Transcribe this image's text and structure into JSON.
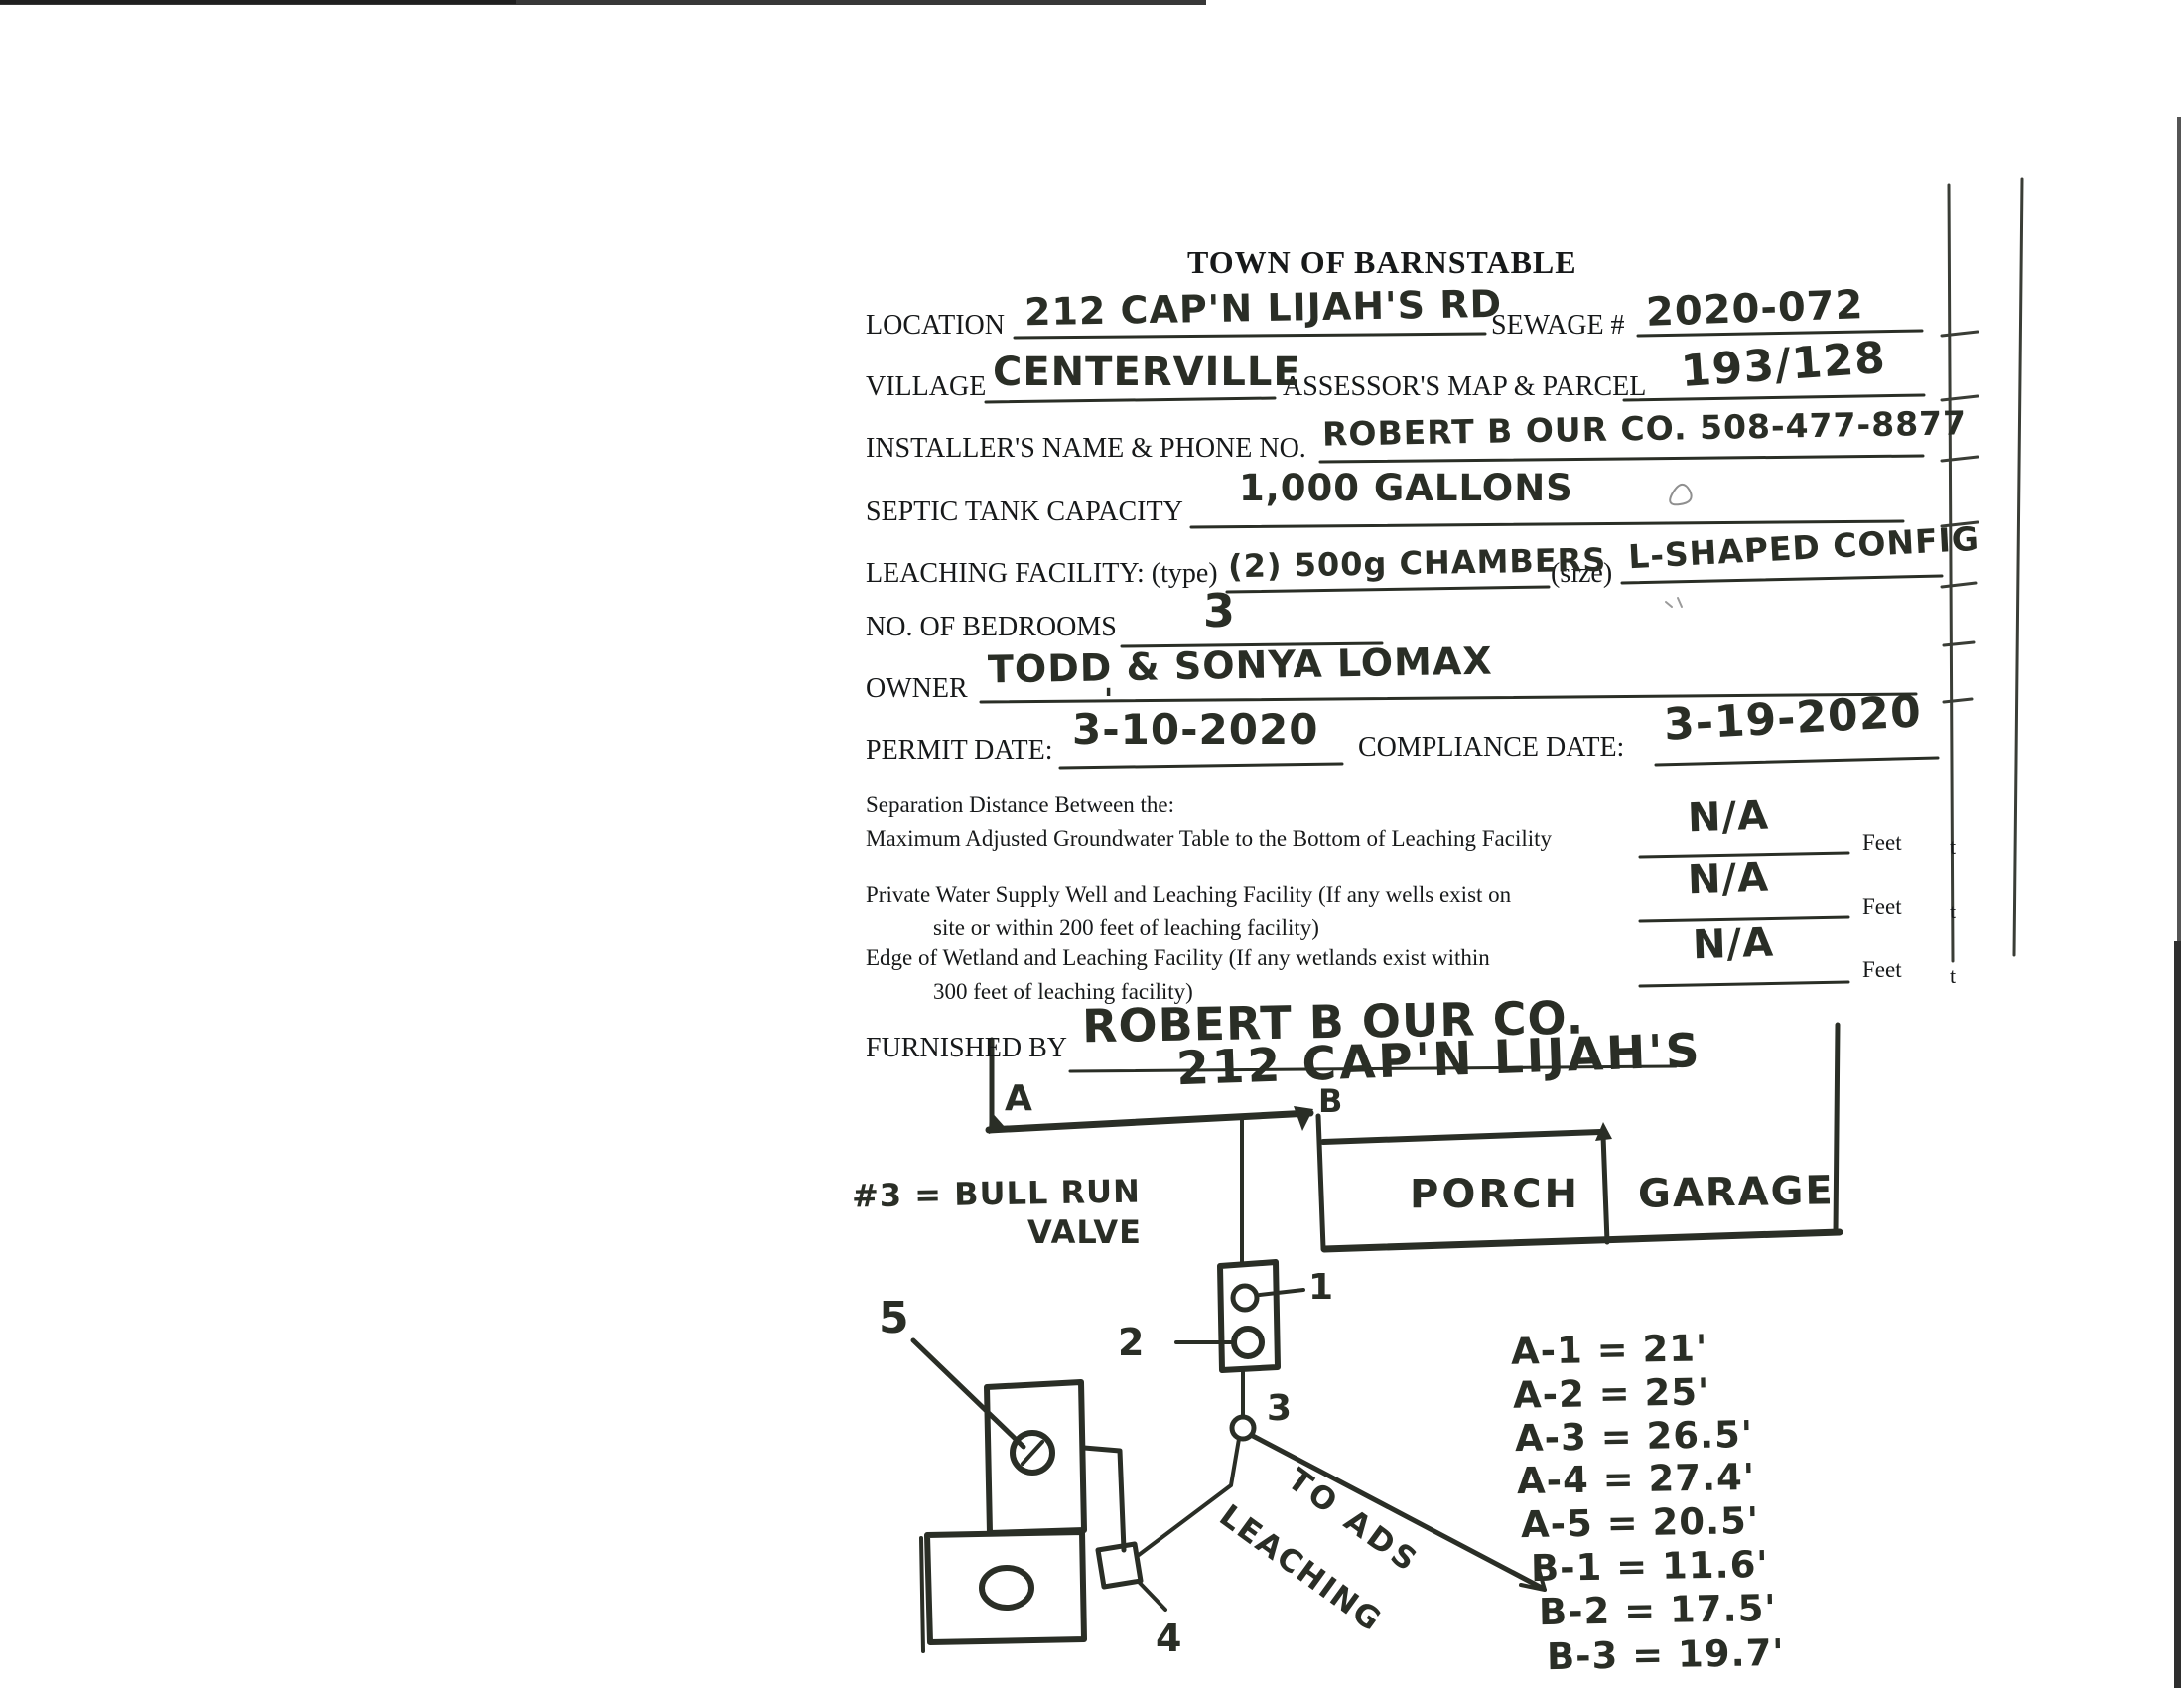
{
  "colors": {
    "ink": "#2a2e26",
    "label_ink": "#17191a",
    "paper": "#ffffff"
  },
  "form": {
    "title": "TOWN OF BARNSTABLE",
    "location_label": "LOCATION",
    "location_value": "212 CAP'N LIJAH'S RD",
    "sewage_label": "SEWAGE #",
    "sewage_value": "2020-072",
    "village_label": "VILLAGE",
    "village_value": "CENTERVILLE",
    "map_parcel_label": "ASSESSOR'S MAP & PARCEL",
    "map_parcel_value": "193/128",
    "installer_label": "INSTALLER'S NAME & PHONE NO.",
    "installer_value": "ROBERT B OUR CO. 508-477-8877",
    "septic_label": "SEPTIC TANK CAPACITY",
    "septic_value": "1,000 GALLONS",
    "leaching_label": "LEACHING FACILITY: (type)",
    "leaching_type_value": "(2) 500g CHAMBERS",
    "size_label": "(size)",
    "size_value": "L-SHAPED CONFIG",
    "bedrooms_label": "NO. OF BEDROOMS",
    "bedrooms_value": "3",
    "owner_label": "OWNER",
    "owner_value": "TODD & SONYA LOMAX",
    "permit_label": "PERMIT DATE:",
    "permit_value": "3-10-2020",
    "permit_stray_mark": "'",
    "compliance_label": "COMPLIANCE DATE:",
    "compliance_value": "3-19-2020",
    "separation_heading": "Separation Distance Between the:",
    "sep_rows": [
      {
        "line1": "Maximum Adjusted Groundwater Table to the Bottom of Leaching Facility",
        "line2": "",
        "value": "N/A",
        "unit": "Feet"
      },
      {
        "line1": "Private Water Supply Well and Leaching Facility (If any wells exist on",
        "line2": "site or within 200 feet of leaching facility)",
        "value": "N/A",
        "unit": "Feet"
      },
      {
        "line1": "Edge of Wetland and Leaching Facility (If any wetlands exist within",
        "line2": "300 feet of leaching facility)",
        "value": "N/A",
        "unit": "Feet"
      }
    ],
    "furnished_label": "FURNISHED BY",
    "furnished_value": "ROBERT B OUR CO."
  },
  "sketch": {
    "title": "212 CAP'N LIJAH'S",
    "corner_a": "A",
    "corner_b": "B",
    "porch": "PORCH",
    "garage": "GARAGE",
    "note_line1": "#3 = BULL RUN",
    "note_line2": "VALVE",
    "arrow_text_line1": "TO ADS",
    "arrow_text_line2": "LEACHING",
    "point_labels": {
      "p1": "1",
      "p2": "2",
      "p3": "3",
      "p4": "4",
      "p5": "5"
    },
    "measurements": [
      {
        "text": "A-1 = 21'"
      },
      {
        "text": "A-2 = 25'"
      },
      {
        "text": "A-3 = 26.5'"
      },
      {
        "text": "A-4 = 27.4'"
      },
      {
        "text": "A-5 = 20.5'"
      },
      {
        "text": "B-1 = 11.6'"
      },
      {
        "text": "B-2 = 17.5'"
      },
      {
        "text": "B-3 = 19.7'"
      }
    ]
  },
  "page_edge": {
    "letters": [
      "t",
      "t",
      "t"
    ]
  }
}
